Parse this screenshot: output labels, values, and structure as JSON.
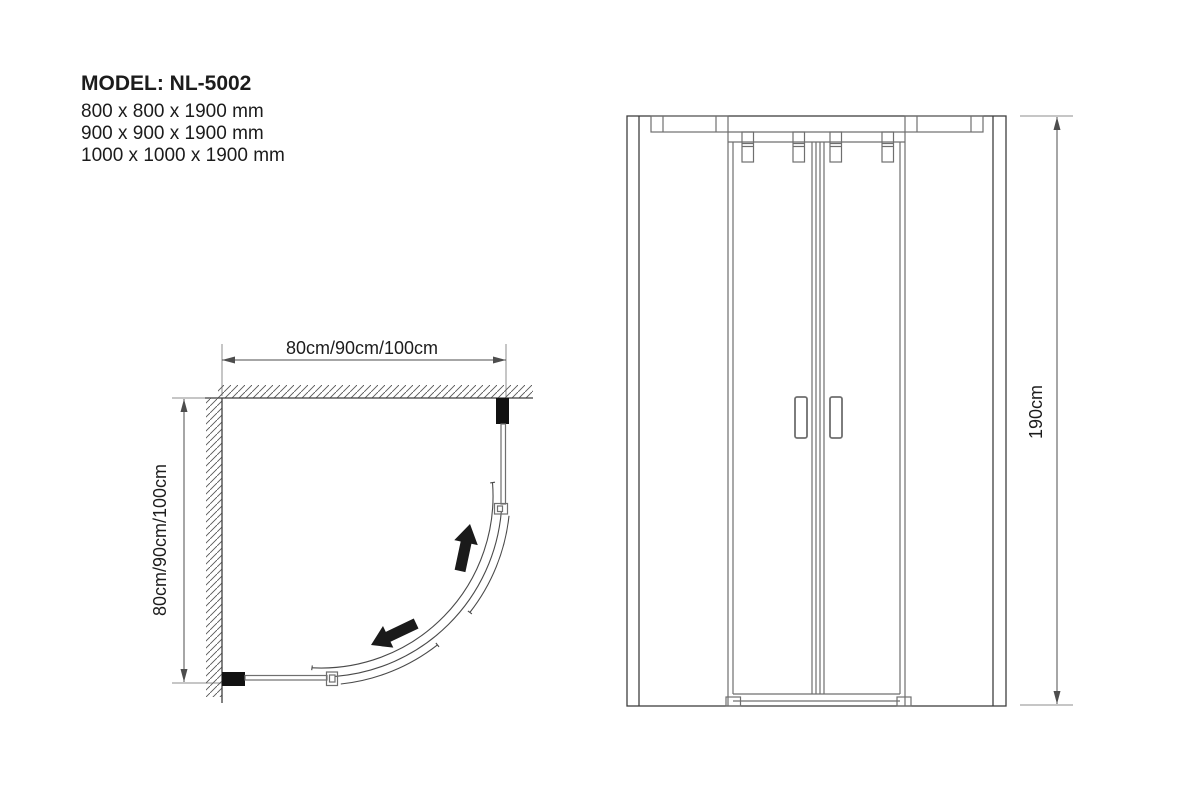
{
  "header": {
    "model_label": "MODEL: NL-5002",
    "sizes": [
      "800 x 800 x 1900 mm",
      "900 x 900 x 1900 mm",
      "1000 x 1000 x 1900 mm"
    ]
  },
  "plan_view": {
    "width_label": "80cm/90cm/100cm",
    "depth_label": "80cm/90cm/100cm"
  },
  "elevation_view": {
    "height_label": "190cm"
  },
  "colors": {
    "drawing_line": "#3f3f3f",
    "secondary_line": "#6f6f6f",
    "dimension_line": "#4d4d4d",
    "extension_line": "#8c8c8c",
    "hatch_line": "#565656",
    "profile_fill": "#111111",
    "text_color": "#1c1c1c",
    "background": "#ffffff"
  }
}
